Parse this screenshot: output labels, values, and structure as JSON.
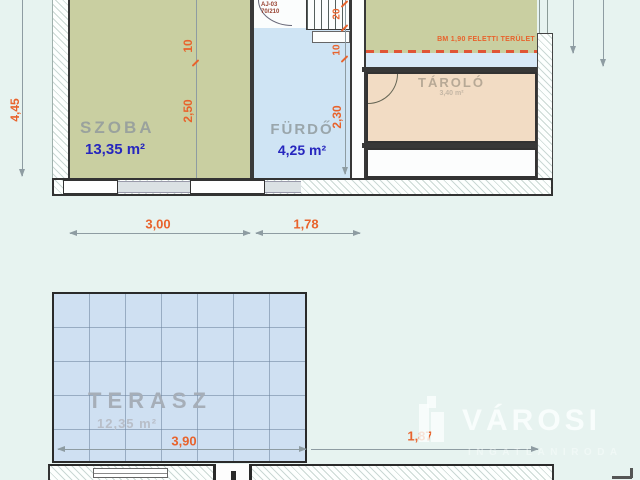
{
  "watermark": {
    "brand": "VÁROSI",
    "subtitle": "INGATLANIRODA"
  },
  "upper": {
    "szoba": {
      "name": "SZOBA",
      "area": "13,35 m²"
    },
    "furdo": {
      "name": "FÜRDŐ",
      "area": "4,25 m²"
    },
    "tarolo": {
      "name": "TÁROLÓ",
      "area": "3,40 m²"
    },
    "door_code": "AJ-03",
    "door_size": "70/210",
    "note": "BM 1,90 FELETTI TERÜLET",
    "dims": {
      "height": "4,45",
      "szoba_d1": "10",
      "szoba_d2": "2,50",
      "stair_d1": "20",
      "stair_d2": "10",
      "furdo_h": "2,30",
      "szoba_w": "3,00",
      "furdo_w": "1,78"
    }
  },
  "lower": {
    "terasz": {
      "name": "TERASZ",
      "area": "12,35 m²"
    },
    "dims": {
      "width": "3,90",
      "right": "1,87"
    }
  },
  "colors": {
    "accent_orange": "#e8632c",
    "area_blue": "#2626be",
    "room_green": "#c9cfa1",
    "bath_blue": "#cfe4f4",
    "storage_peach": "#f2dcc4",
    "terrace_blue": "#cfe0f2"
  }
}
